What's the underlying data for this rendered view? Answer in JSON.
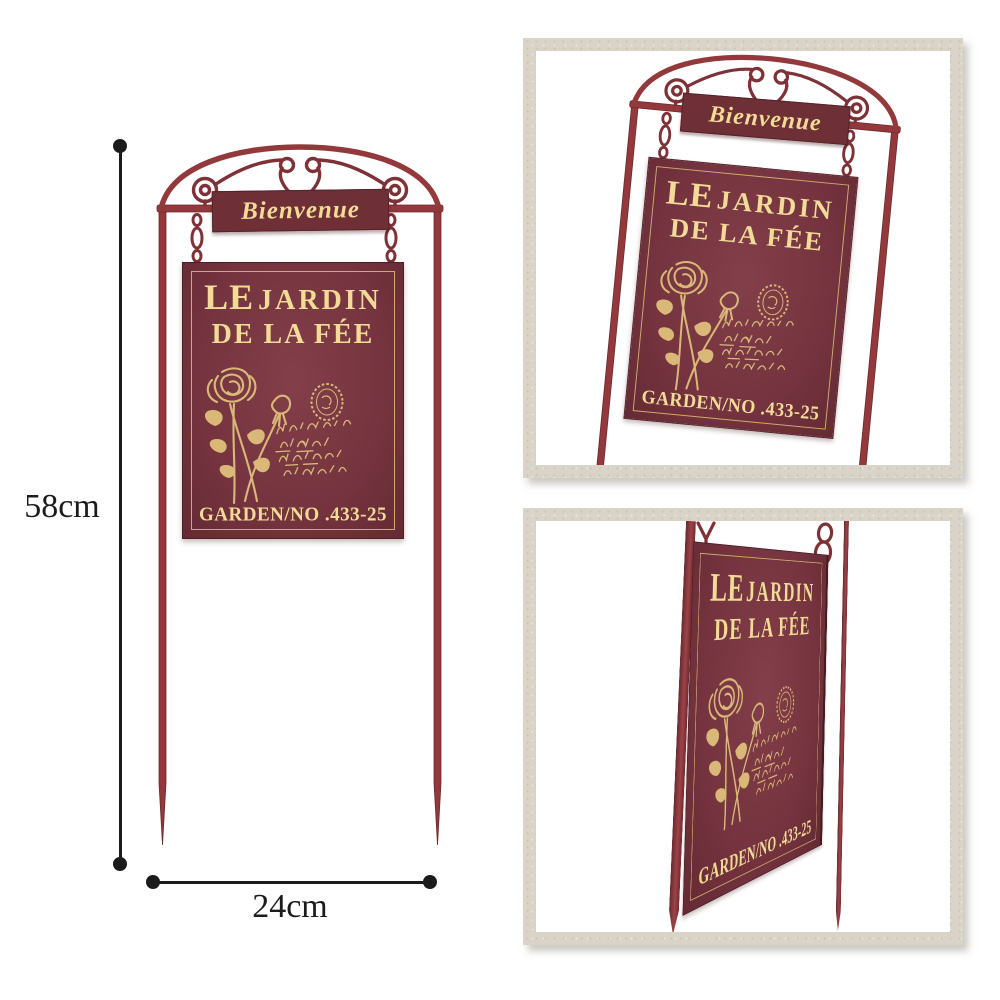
{
  "sign": {
    "banner": "Bienvenue",
    "title_le": "LE",
    "title_jardin": "JARDIN",
    "title_line2": "DE LA FÉE",
    "number": "GARDEN/NO .433-25"
  },
  "dimensions": {
    "height": "58cm",
    "width": "24cm"
  },
  "colors": {
    "metal_maroon": "#93383b",
    "metal_dark": "#7e3136",
    "plate_maroon": "#74333e",
    "plate_maroon_light": "#833f4a",
    "plaque_maroon": "#6e2f37",
    "gold_text": "#f1db97",
    "gold_line": "#d9b878",
    "frame_beige": "#d9d4c7",
    "dim_black": "#1b1b1b",
    "bg": "#ffffff"
  }
}
